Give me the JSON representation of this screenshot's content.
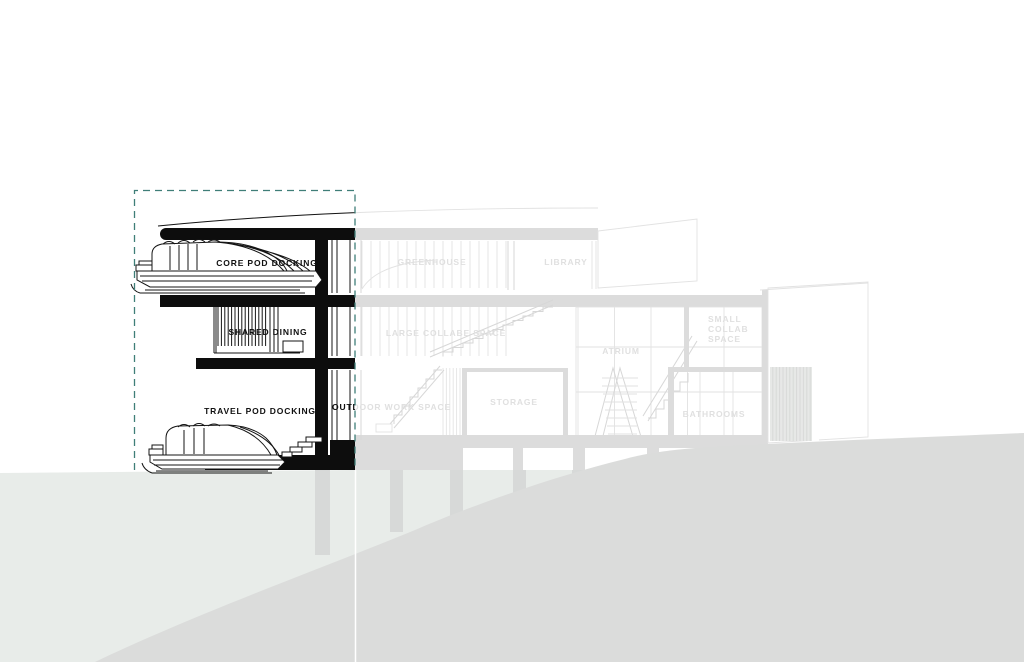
{
  "figure": {
    "title": "building-section-diagram",
    "selected_zone": {
      "labels": {
        "core_pod_docking": "CORE POD DOCKING",
        "shared_dining": "SHARED DINING",
        "travel_pod_docking": "TRAVEL POD DOCKING"
      }
    },
    "faded_zone": {
      "labels": {
        "greenhouse": "GREENHOUSE",
        "library": "LIBRARY",
        "large_collab_space": "LARGE COLLABE SPACE",
        "atrium": "ATRIUM",
        "small_collab_line1": "SMALL",
        "small_collab_line2": "COLLAB",
        "small_collab_line3": "SPACE",
        "outdoor_work_space": "OUTDOOR WORK SPACE",
        "storage": "STORAGE",
        "bathrooms": "BATHROOMS"
      }
    },
    "colors": {
      "ink": "#111111",
      "faded_gray": "#dcdcdc",
      "terrain_light": "#e8ece9",
      "terrain_dark": "#dbdcdb",
      "selection_teal": "#3f7e78"
    }
  }
}
